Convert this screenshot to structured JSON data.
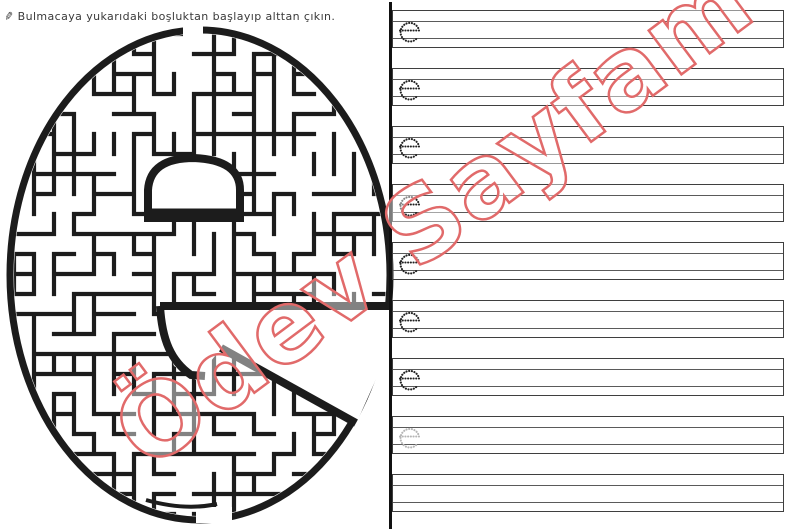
{
  "instruction": {
    "icon": "pencil-icon",
    "icon_glyph": "✎",
    "text": "Bulmacaya yukarıdaki boşluktan başlayıp alttan çıkın."
  },
  "maze": {
    "letter": "e",
    "wall_color": "#1c1c1c",
    "outline_color": "#1c1c1c"
  },
  "watermark": {
    "text": "Ödev Sayfam",
    "color": "#e16a6a"
  },
  "practice": {
    "letter_colors": {
      "black": "#222222",
      "gray": "#b6b6b6"
    },
    "rows": [
      {
        "letter": "e",
        "tone": "black"
      },
      {
        "letter": "e",
        "tone": "black"
      },
      {
        "letter": "e",
        "tone": "black"
      },
      {
        "letter": "e",
        "tone": "black"
      },
      {
        "letter": "e",
        "tone": "black"
      },
      {
        "letter": "e",
        "tone": "black"
      },
      {
        "letter": "e",
        "tone": "black"
      },
      {
        "letter": "e",
        "tone": "gray"
      },
      {
        "letter": "",
        "tone": ""
      }
    ]
  },
  "colors": {
    "paper": "#ffffff",
    "line_border": "#3f3f3f",
    "line_inner": "#5a5a5a",
    "divider": "#111111"
  }
}
